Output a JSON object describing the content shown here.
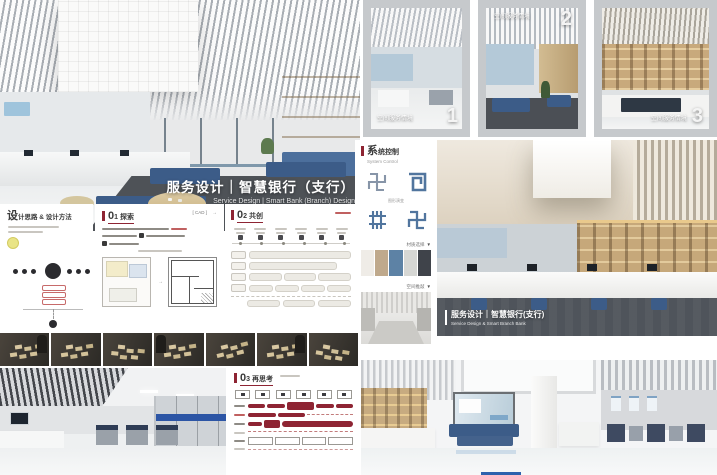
{
  "colors": {
    "accent": "#8e2433",
    "steel_blue": "#51759e",
    "navy": "#3c5c88",
    "beige": "#c9ae84",
    "carpet_gray": "#4e5257",
    "frame_gray": "#c6c9cc",
    "swatches": [
      "#efece7",
      "#bfa98c",
      "#5d82a5",
      "#d6d7d4",
      "#3f434a"
    ]
  },
  "hero": {
    "title": "服务设计｜智慧银行（支行）",
    "subtitle": "Service Design | Smart Bank (Branch) Design"
  },
  "scenarios": {
    "label": "空间服务情境",
    "items": [
      {
        "num": "1"
      },
      {
        "num": "2"
      },
      {
        "num": "3"
      }
    ]
  },
  "pattern_panel": {
    "title": "系统控制",
    "subtitle": "System Control",
    "evolve_label": "图形演变",
    "materials_label": "材质选择",
    "sketch_label": "空间推敲",
    "chevron": "▼",
    "glyphs": [
      "fret-gray",
      "spiral-blue",
      "fret-dense-blue",
      "fret-blue"
    ]
  },
  "main_render": {
    "caption": "服务设计｜智慧银行(支行)",
    "caption_en": "Service Design & Smart Branch Bank"
  },
  "method_panel": {
    "title": "设计思路 & 设计方法"
  },
  "explore_panel": {
    "title": "01 探索",
    "tag": "[ CAD ]",
    "arrow": "→"
  },
  "cocreate_panel": {
    "title": "02 共创"
  },
  "rethink_panel": {
    "title": "03 再思考"
  }
}
